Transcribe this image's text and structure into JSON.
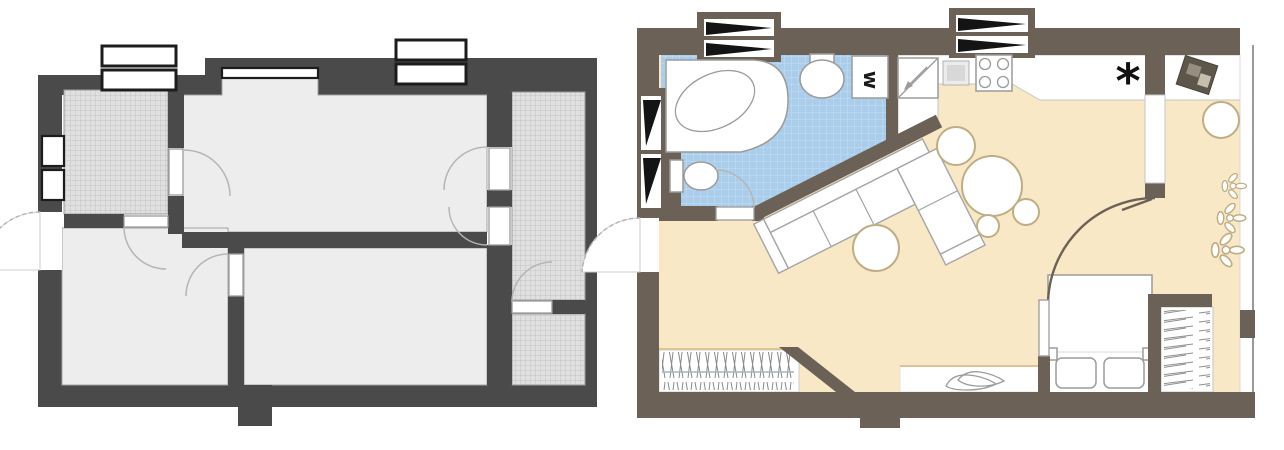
{
  "css_vars": {
    "--page-bg": "#ffffff",
    "--wall-before": "#4a4a4a",
    "--floor-before": "#ededed",
    "--hatch-bg": "#e0e0e0",
    "--hatch-line": "#bdbdbd",
    "--outline-before": "#a3a3a3",
    "--arc-gray": "#b5b5b5",
    "--frame-black": "#1c1c1c",
    "--wall-after": "#6b6156",
    "--floor-after": "#f8e8c6",
    "--tile-bg": "#a9cdea",
    "--tile-line": "#c6def2",
    "--fixture-stroke": "#9b9b9b",
    "--furniture-tan": "#bfae83",
    "--accent-line-tan": "#dcc497"
  },
  "plans": {
    "before": {
      "id": "floor-plan-before",
      "colors": {
        "wall": "#4a4a4a",
        "floor": "#ededed",
        "hatch": "#e0e0e0"
      },
      "features": [
        "hatched-room-top-left",
        "large-room",
        "two-lower-rooms",
        "hatched-loggia-strip",
        "hatched-room-bottom-right",
        "six-door-swings",
        "three-windows",
        "entrance-door-left",
        "column-bottom"
      ]
    },
    "after": {
      "id": "floor-plan-after",
      "colors": {
        "wall": "#6b6156",
        "floor": "#f8e8c6",
        "bath_tile": "#a9cdea"
      },
      "labels": {
        "washing_machine": "w",
        "refrigerator": "*"
      },
      "fixtures": {
        "bathroom": [
          "corner-bathtub",
          "washbasin",
          "toilet",
          "washing-machine"
        ],
        "kitchen": [
          "sink-unit",
          "worktop",
          "cooktop",
          "refrigerator"
        ],
        "living": [
          "corner-sofa",
          "coffee-table",
          "dining-table",
          "stools"
        ],
        "bedroom": [
          "double-bed",
          "pillows",
          "wardrobe",
          "curved-partition"
        ],
        "decor": [
          "plants",
          "tv-unit",
          "stool",
          "shoes",
          "clothes-rail",
          "entrance-door"
        ]
      }
    }
  }
}
